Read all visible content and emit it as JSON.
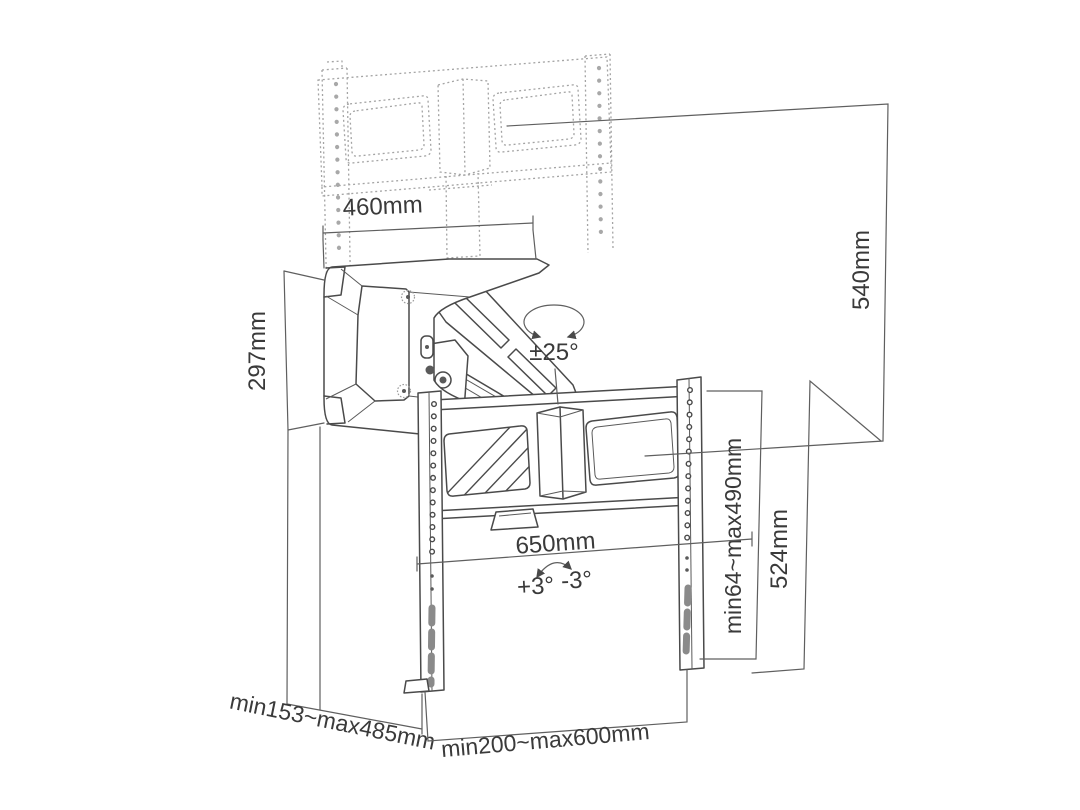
{
  "diagram": {
    "type": "technical-dimension-drawing",
    "subject": "pull-down TV wall mount bracket",
    "background": "#ffffff",
    "line_color": "#4a4a4a",
    "ghost_line_color": "#a4a4a4",
    "dimension_line_color": "#5f5f5f",
    "text_color": "#3a3a3a",
    "labels": {
      "wall_plate_width": "460mm",
      "wall_plate_height": "297mm",
      "tilt_range": "±25°",
      "vertical_travel": "540mm",
      "vesa_vertical_range": "min64~max490mm",
      "bracket_height": "524mm",
      "bracket_width": "650mm",
      "level_adjust_plus": "+3°",
      "level_adjust_minus": "-3°",
      "extension_depth_range": "min153~max485mm",
      "vesa_horizontal_range": "min200~max600mm"
    }
  }
}
